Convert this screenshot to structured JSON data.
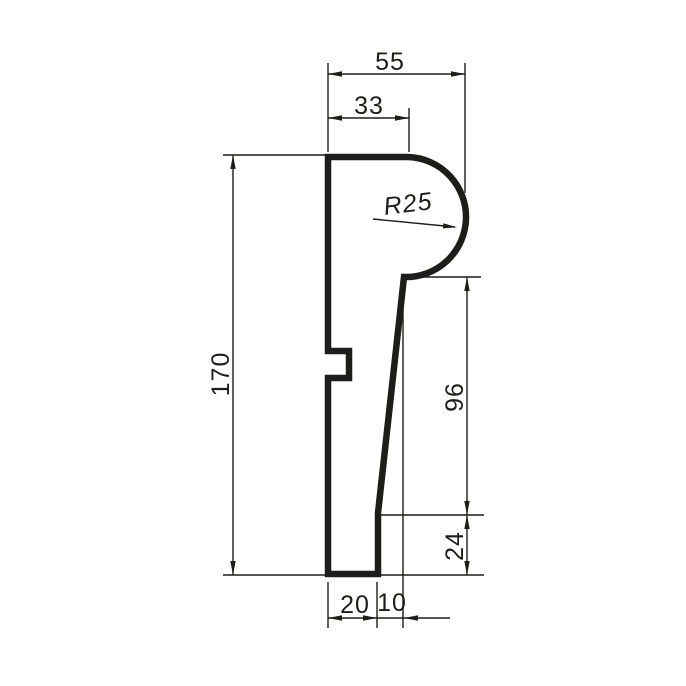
{
  "drawing": {
    "kind": "dimensioned-profile-cross-section",
    "colors": {
      "line": "#1d1d1b",
      "background": "#ffffff"
    },
    "dimensions": {
      "top_overall_width": "55",
      "top_flat_width": "33",
      "bulb_radius": "R25",
      "overall_height": "170",
      "slant_height": "96",
      "foot_height": "24",
      "bottom_width": "20",
      "bottom_offset": "10"
    }
  }
}
